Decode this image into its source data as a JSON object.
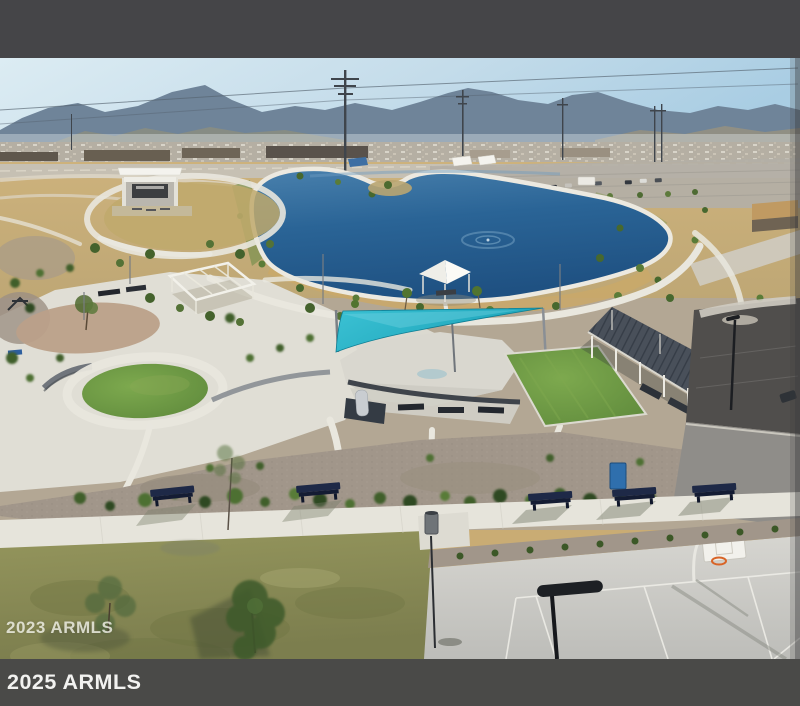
{
  "frame": {
    "top_bar_color": "#454548",
    "bottom_bar_color": "#4a4a48"
  },
  "watermarks": {
    "photo_overlay": "2023 ARMLS",
    "bottom_bar": "2025 ARMLS",
    "overlay_color": "rgba(248,248,240,0.78)",
    "bar_text_color": "#f2f2f0"
  },
  "photo": {
    "description": "Aerial drone view of a desert community park: blue lake with fountain, amphitheater stage, white pergola and gazebo, teal shade sail over splash pad, slatted ramada with picnic tables, green turf circle and lawn, gravel landscaping with shrubs, curving walking paths, benches, grass field and basketball court, with mountains, power lines and suburban rooftops on the horizon",
    "features": [
      "sky",
      "mountain-range",
      "city-skyline-strip",
      "power-lines",
      "lake",
      "fountain",
      "amphitheater-stage",
      "pergola",
      "gazebo",
      "teal-shade-sail",
      "splash-pad",
      "ramada",
      "turf-circle",
      "turf-lawn",
      "gravel-landscaping",
      "walking-paths",
      "walkway",
      "benches",
      "grass-field",
      "basketball-court",
      "basketball-hoop",
      "street-lamp",
      "parking-lot"
    ],
    "palette": {
      "sky_left": "#dcecf3",
      "sky_right": "#a9cde3",
      "mountains": "#6f8499",
      "city_strip": "#b5afa3",
      "desert_tan": "#c9ac74",
      "lake_light": "#4a81ad",
      "lake_mid": "#2a6496",
      "lake_deep": "#1f5182",
      "concrete_path": "#e8e6dd",
      "shade_sail": "#1aa2b8",
      "turf": "#5f8a3c",
      "ramada_roof": "#49505a",
      "gravel": "#a1968a",
      "grass_field": "#8f9156",
      "court": "#c9c9c5",
      "hoop_rim": "#d86427"
    }
  }
}
